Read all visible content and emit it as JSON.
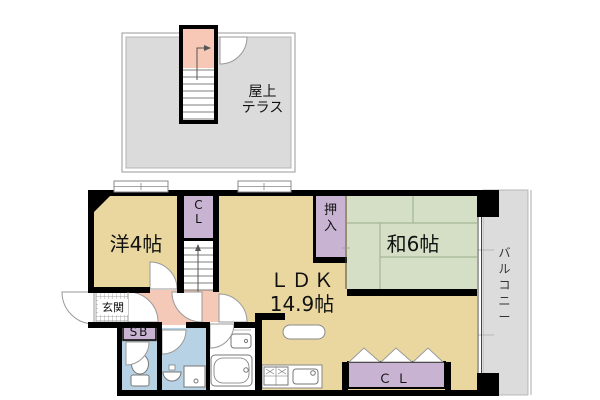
{
  "colors": {
    "room-beige": "#EAD7A0",
    "tatami-green": "#D4DFC6",
    "tatami-line": "#A4B795",
    "closet-purple": "#C8B4D2",
    "hall-pink": "#F4C9B8",
    "stair-pink": "#F6C8B5",
    "wet-blue": "#B7D2E4",
    "terrace-gray": "#DBDBDB",
    "balcony-gray": "#DCDCDC",
    "wall-black": "#000000",
    "fixture-line": "#777777",
    "door-line": "#999999"
  },
  "rooftop": {
    "label": "屋上\nテラス"
  },
  "rooms": {
    "western": "洋4帖",
    "closet_top": "C\nL",
    "ldk_name": "ＬＤＫ",
    "ldk_size": "14.9帖",
    "oshiire": "押\n入",
    "japanese": "和6帖",
    "balcony": "バ\nル\nコ\nニ\nー",
    "entrance": "玄関",
    "shoebox": "SB",
    "closet_bottom": "ＣＬ"
  },
  "icons": {
    "stairs-up-arrow-icon": "arrow-polyline",
    "door-swing-icon": "quarter-circle",
    "window-icon": "double-rect",
    "toilet-icon": "ellipse+tank",
    "bathtub-icon": "rounded-rect",
    "bathroom-sink-icon": "rounded-rect+dot",
    "washbasin-icon": "semicircle",
    "washing-machine-icon": "square+dot",
    "stove-icon": "grid-2x2",
    "kitchen-sink-icon": "rounded-rect+dot",
    "folding-door-icon": "triangles",
    "kitchen-counter-icon": "rounded-bar"
  }
}
